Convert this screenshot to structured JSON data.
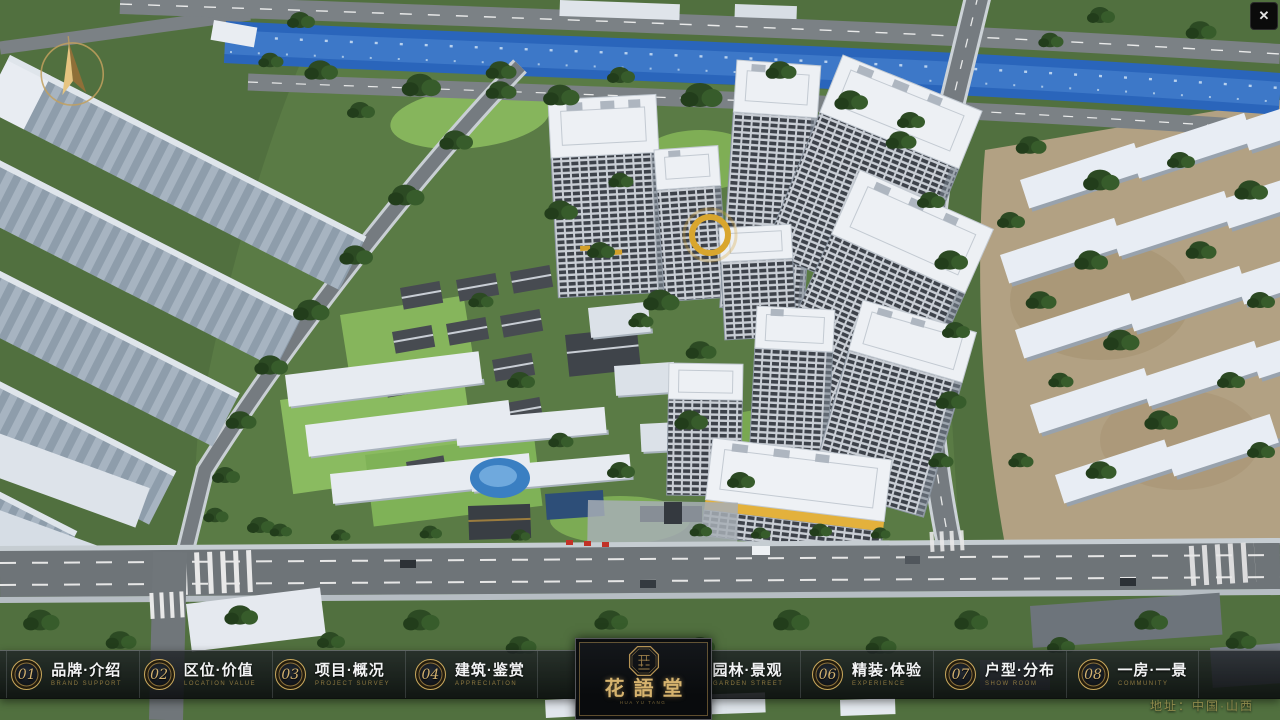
{
  "icons": {
    "close": "✕",
    "compass": "north-arrow",
    "logo_seal": "octagon-seal"
  },
  "nav": {
    "left": [
      {
        "num": "01",
        "zh": "品牌·介绍",
        "en": "BRAND SUPPORT"
      },
      {
        "num": "02",
        "zh": "区位·价值",
        "en": "LOCATION VALUE"
      },
      {
        "num": "03",
        "zh": "项目·概况",
        "en": "PROJECT SURVEY"
      },
      {
        "num": "04",
        "zh": "建筑·鉴赏",
        "en": "APPRECIATION"
      }
    ],
    "right": [
      {
        "num": "05",
        "zh": "园林·景观",
        "en": "GARDEN STREET"
      },
      {
        "num": "06",
        "zh": "精装·体验",
        "en": "EXPERIENCE"
      },
      {
        "num": "07",
        "zh": "户型·分布",
        "en": "SHOW ROOM"
      },
      {
        "num": "08",
        "zh": "一房·一景",
        "en": "COMMUNITY"
      }
    ]
  },
  "logo": {
    "title": "花語堂",
    "caption": "HUA YU TANG"
  },
  "footer": {
    "address": "地址：中国·山西"
  },
  "colors": {
    "gold": "#c9a85c",
    "text": "#f3f4f5",
    "en_text": "#8d7840",
    "bar_top": "rgba(30,34,38,0.80)",
    "bar_bottom": "rgba(8,10,12,0.88)"
  }
}
